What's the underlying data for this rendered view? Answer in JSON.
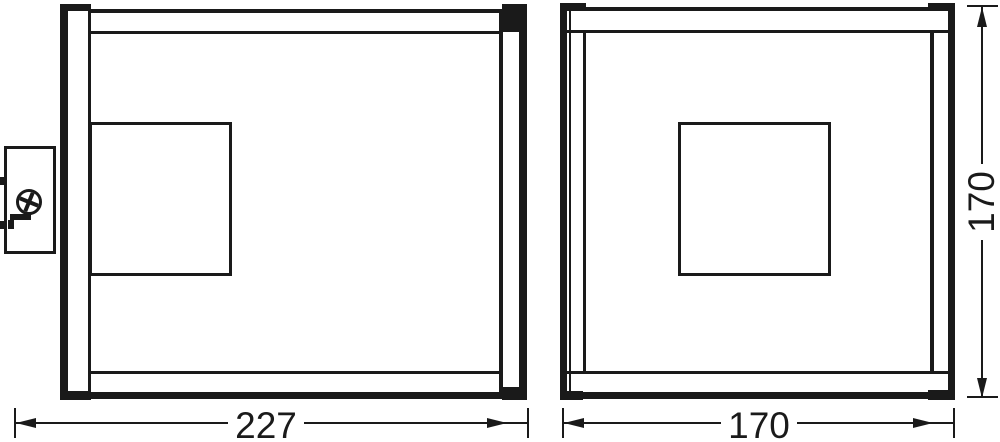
{
  "drawing": {
    "background_color": "#ffffff",
    "ink_color": "#1a1a1a"
  },
  "dimensions": {
    "side_width": {
      "label": "227"
    },
    "front_width": {
      "label": "170"
    },
    "front_height": {
      "label": "170"
    }
  }
}
